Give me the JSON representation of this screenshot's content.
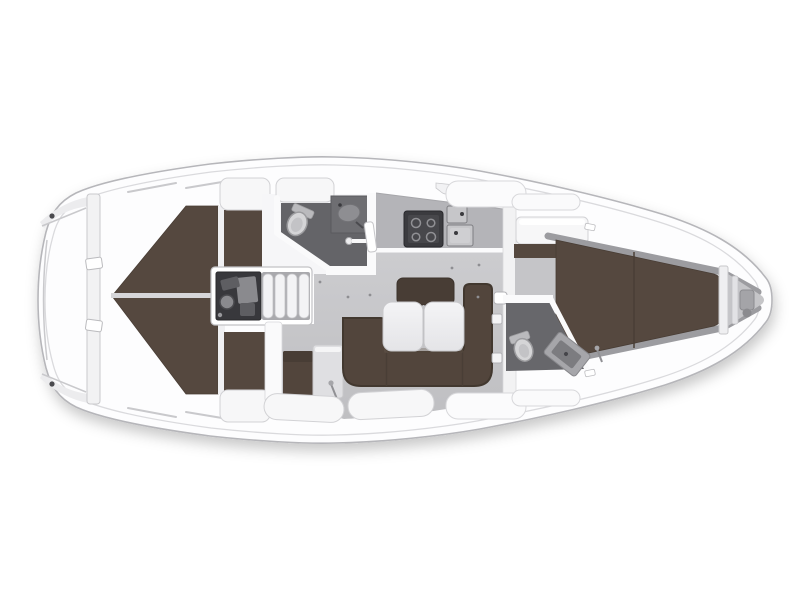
{
  "meta": {
    "title": "Sailing yacht interior layout floor plan (top view)",
    "view": "overhead deck plan",
    "visible_text": []
  },
  "colors": {
    "canvas": "#ffffff",
    "hull": "#fdfdfe",
    "hull_stroke": "#b6b6ba",
    "deck_line": "#dadadd",
    "line_soft": "#c9c9cc",
    "floor_light": "#cccccf",
    "floor_dark": "#bfbfc2",
    "wet_floor": "#646468",
    "wet_floor_fwd": "#67676b",
    "counter": "#b4b4b8",
    "counter_edge": "#fbfbfc",
    "stove_body": "#3b3b3f",
    "stove_panel": "#47474b",
    "burner": "#909094",
    "sink_fill": "#c6c6c9",
    "sink_inner": "#cfcfd2",
    "sink_stroke": "#7e7e82",
    "sink_dot": "#3a3a3e",
    "basin": "#8e8e92",
    "berth": "#55483f",
    "berth_edge": "#483d35",
    "berth_divider": "#d6d6d9",
    "berth_seam": "#493e36",
    "settee": "#52453c",
    "settee_edge": "#42382f",
    "backrest": "#483d35",
    "table_stroke": "#c8c8cb",
    "table_top": "#f4f4f6",
    "table_bottom": "#e4e4e7",
    "engine_bg": "#38383c",
    "engine_part_light": "#8a8a8e",
    "engine_part_mid": "#5e5e62",
    "steps_bg": "#a9a9ad",
    "tread": "#f3f3f5",
    "tread_stroke": "#c5c5c8",
    "white_comp": "#f7f7f8",
    "comp_stroke": "#d2d2d5",
    "bulkhead": "#f2f2f3",
    "toilet": "#d5d5d7",
    "toilet_stroke": "#9c9c9f",
    "toilet_tank": "#bababd",
    "toilet_inner": "#c3c3c6",
    "vanity": "#a6a6aa",
    "vanity_inner": "#7c7c80",
    "bow_wall": "#9c9ca0",
    "bow_floor": "#c5c5c8",
    "windlass": "#a4a4a8",
    "windlass_dark": "#8b8b8f",
    "dot_dark": "#4a4a4e",
    "screw_dot": "#8e8e92"
  },
  "parts": {
    "hull": "hull outline",
    "stern_platform": "stern swim platform",
    "aft_cabin_port": "port aft double berth",
    "aft_cabin_starboard": "starboard aft double berth",
    "engine": "engine compartment",
    "companionway": "companionway steps",
    "aft_head": "aft bathroom with toilet and sink",
    "galley": "galley with stove and double sink",
    "saloon": "saloon with U-settee and folding table",
    "fwd_head": "forward bathroom",
    "fwd_cabin": "forward V-berth cabin",
    "anchor_locker": "bow anchor locker with windlass"
  }
}
